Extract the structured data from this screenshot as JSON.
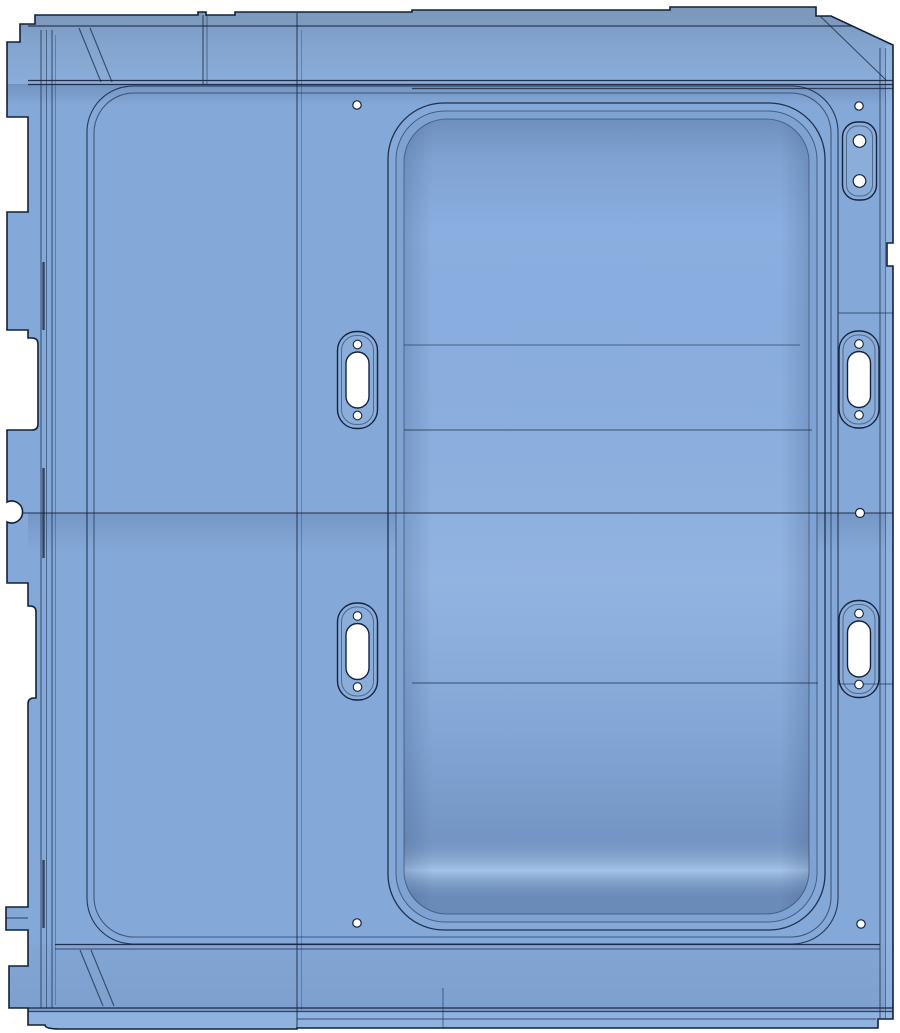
{
  "scene": {
    "type": "cad-part-view",
    "part": "sheet-metal-panel",
    "width": 900,
    "height": 1033,
    "background": "#ffffff"
  },
  "palette": {
    "base": "#84a8d8",
    "outline": "#10203c",
    "line": "#16233e",
    "railTop": "#7490b6",
    "railMid": "#82a4ce",
    "railBottom": "#8aacd8",
    "topLip": "#8099bc",
    "bottomFaceTop": "#82a5d4",
    "bottomFaceBottom": "#7da0cf",
    "bottomLip": "#8fb2df",
    "recessWall": "#7ea2d2",
    "recessFloor": "#8aaedf",
    "rightStrip": "#9fbce4",
    "holeFill": "#ffffff"
  },
  "grooves": {
    "outer": {
      "x": 87,
      "y": 86,
      "w": 751,
      "h": 858,
      "r": 46
    },
    "inner": {
      "x": 94,
      "y": 93,
      "w": 737,
      "h": 844,
      "r": 40
    }
  },
  "recess": {
    "outer": {
      "x": 388,
      "y": 103,
      "w": 437,
      "h": 827,
      "r": 56
    },
    "mid": {
      "x": 396,
      "y": 111,
      "w": 421,
      "h": 811,
      "r": 49
    },
    "floor": {
      "x": 404,
      "y": 119,
      "w": 405,
      "h": 795,
      "r": 43
    }
  },
  "features": {
    "holes": [
      {
        "cx": 357,
        "cy": 105,
        "r": 4.2
      },
      {
        "cx": 859,
        "cy": 106,
        "r": 4.2
      },
      {
        "cx": 860,
        "cy": 513,
        "r": 4.5
      },
      {
        "cx": 357,
        "cy": 923,
        "r": 4.2
      },
      {
        "cx": 861,
        "cy": 924,
        "r": 4.2
      }
    ],
    "slot_bosses": [
      {
        "cx": 357.5,
        "cy": 380
      },
      {
        "cx": 357.5,
        "cy": 651.5
      },
      {
        "cx": 859.0,
        "cy": 379.5
      },
      {
        "cx": 859.0,
        "cy": 649
      }
    ],
    "slot_boss_size": {
      "w": 40,
      "h": 97,
      "r": 19,
      "slot_w": 23,
      "slot_h": 56,
      "hole_r": 4.3,
      "hole_offset": 35.5
    },
    "hole_bosses": [
      {
        "cx": 859.5,
        "cy": 161
      }
    ],
    "hole_boss_size": {
      "w": 34,
      "h": 78,
      "r": 15,
      "hole_r": 6.3,
      "hole_offset": 20
    },
    "creases_h": [
      {
        "x1": 22,
        "y1": 513,
        "x2": 893,
        "y2": 513,
        "o": 0.9
      },
      {
        "x1": 404,
        "y1": 345,
        "x2": 800,
        "y2": 345,
        "o": 0.55
      },
      {
        "x1": 404,
        "y1": 430,
        "x2": 812,
        "y2": 430,
        "o": 0.7
      },
      {
        "x1": 412,
        "y1": 683,
        "x2": 818,
        "y2": 683,
        "o": 0.7
      },
      {
        "x1": 838,
        "y1": 313,
        "x2": 893,
        "y2": 313,
        "o": 0.65
      },
      {
        "x1": 838,
        "y1": 684,
        "x2": 893,
        "y2": 684,
        "o": 0.65
      },
      {
        "x1": 6,
        "y1": 918,
        "x2": 28,
        "y2": 918,
        "o": 0.8
      }
    ],
    "creases_v": [
      {
        "x": 297,
        "y1": 13,
        "y2": 1028,
        "o": 0.85
      },
      {
        "x": 301.5,
        "y1": 30,
        "y2": 1010,
        "o": 0.3
      },
      {
        "x": 203,
        "y1": 15,
        "y2": 84,
        "o": 0.8
      },
      {
        "x": 207,
        "y1": 15,
        "y2": 84,
        "o": 0.5
      },
      {
        "x": 443,
        "y1": 988,
        "y2": 1028,
        "o": 0.55
      },
      {
        "x": 41,
        "y1": 30,
        "y2": 1008,
        "o": 0.7
      },
      {
        "x": 46.5,
        "y1": 30,
        "y2": 1008,
        "o": 0.5
      },
      {
        "x": 52,
        "y1": 30,
        "y2": 1008,
        "o": 0.7
      },
      {
        "x": 55.5,
        "y1": 35,
        "y2": 1005,
        "o": 0.3
      },
      {
        "x": 880,
        "y1": 48,
        "y2": 1018,
        "o": 0.7
      },
      {
        "x": 885.5,
        "y1": 48,
        "y2": 1018,
        "o": 0.45
      }
    ],
    "rail_lines": [
      {
        "y": 26,
        "x1": 28,
        "x2": 893,
        "o": 0.8
      },
      {
        "y": 80.5,
        "x1": 28,
        "x2": 893,
        "o": 0.9
      },
      {
        "y": 84.5,
        "x1": 28,
        "x2": 893,
        "o": 0.9
      },
      {
        "y": 88.5,
        "x1": 412,
        "x2": 893,
        "o": 0.75
      }
    ],
    "bottom_lines": [
      {
        "y": 944.5,
        "x1": 55,
        "x2": 880,
        "o": 0.9
      },
      {
        "y": 949,
        "x1": 55,
        "x2": 880,
        "o": 0.55
      },
      {
        "y": 1008,
        "x1": 28,
        "x2": 893,
        "o": 0.95
      },
      {
        "y": 1011.5,
        "x1": 28,
        "x2": 893,
        "o": 0.75
      },
      {
        "y": 1019,
        "x1": 297,
        "x2": 876,
        "o": 0.55
      }
    ],
    "diagonals": [
      {
        "x1": 79,
        "y1": 28,
        "x2": 101,
        "y2": 82
      },
      {
        "x1": 90,
        "y1": 28,
        "x2": 112,
        "y2": 82
      },
      {
        "x1": 80,
        "y1": 950,
        "x2": 103,
        "y2": 1006
      },
      {
        "x1": 91,
        "y1": 950,
        "x2": 114,
        "y2": 1006
      },
      {
        "x1": 820,
        "y1": 16,
        "x2": 886,
        "y2": 80
      }
    ],
    "flange_dashes": [
      {
        "x": 43.5,
        "y1": 262,
        "y2": 330
      },
      {
        "x": 43.5,
        "y1": 468,
        "y2": 558
      },
      {
        "x": 43.5,
        "y1": 860,
        "y2": 928
      }
    ]
  }
}
